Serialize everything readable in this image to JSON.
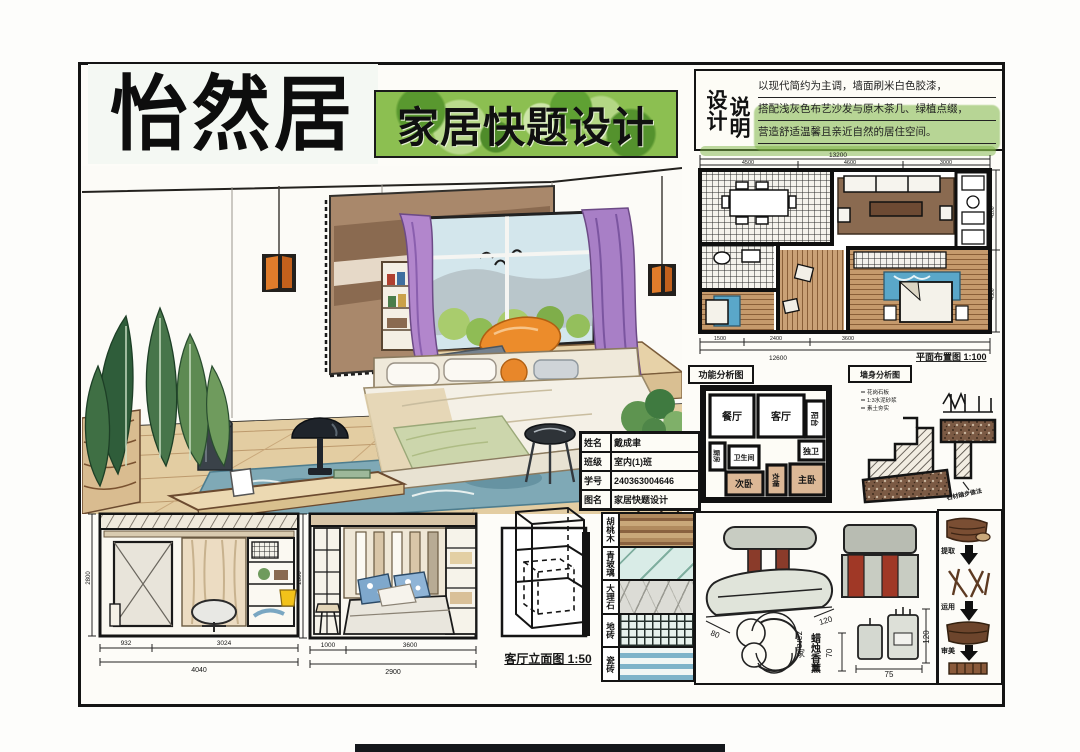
{
  "title": {
    "text": "怡然居"
  },
  "banner": {
    "text": "家居快题设计"
  },
  "design_notes": {
    "label_col1": "设计",
    "label_col2": "说明",
    "line1": "以现代简约为主调，墙面刷米白色胶漆，",
    "line2": "搭配浅灰色布艺沙发与原木茶几、绿植点缀，",
    "line3": "营造舒适温馨且亲近自然的居住空间。"
  },
  "floor_plan": {
    "caption": "平面布置图 1:100",
    "dim_top_total": "13200",
    "dim_top_segs": [
      "4500",
      "4600",
      "3000"
    ],
    "dim_bottom_segs": [
      "1500",
      "2400",
      "3600"
    ],
    "dim_bottom_total": "12600",
    "dim_right": [
      "4200",
      "4500"
    ]
  },
  "info_table": {
    "rows": [
      {
        "label": "姓名",
        "value": "戴成聿"
      },
      {
        "label": "班级",
        "value": "室内(1)班"
      },
      {
        "label": "学号",
        "value": "240363004646"
      },
      {
        "label": "图名",
        "value": "家居快题设计"
      }
    ]
  },
  "function_diagram": {
    "title": "功能分析图",
    "rooms": {
      "dining": "餐厅",
      "living": "客厅",
      "balcony": "阳台",
      "kitchen": "厨房",
      "bath": "卫生间",
      "ensuite": "独卫",
      "bedroom2": "次卧",
      "closet": "衣帽",
      "master": "主卧"
    }
  },
  "wall_section": {
    "title": "墙身分析图",
    "notes": [
      "花岗石板",
      "1:3水泥砂浆",
      "素土夯实"
    ],
    "callout": "石材踏步做法"
  },
  "elevation1": {
    "dim_left": "2800",
    "dims_bottom": [
      "932",
      "3024"
    ],
    "dim_total": "4040"
  },
  "elevation2": {
    "dim_left": "2800",
    "dims_bottom": [
      "1000",
      "3600"
    ],
    "dim_total": "2900"
  },
  "cube": {
    "caption": "客厅立面图 1:50"
  },
  "materials": [
    {
      "name": "胡桃木"
    },
    {
      "name": "青玻璃"
    },
    {
      "name": "大理石"
    },
    {
      "name": "地砖"
    },
    {
      "name": "瓷砖"
    }
  ],
  "props": {
    "note1": "蜡烛香薰",
    "note2": "zara家",
    "dims": {
      "w": "80",
      "d": "120",
      "h": "70",
      "w2": "75",
      "h2": "120"
    }
  },
  "concept_flow": {
    "steps": [
      "提取",
      "运用",
      "审美"
    ]
  }
}
